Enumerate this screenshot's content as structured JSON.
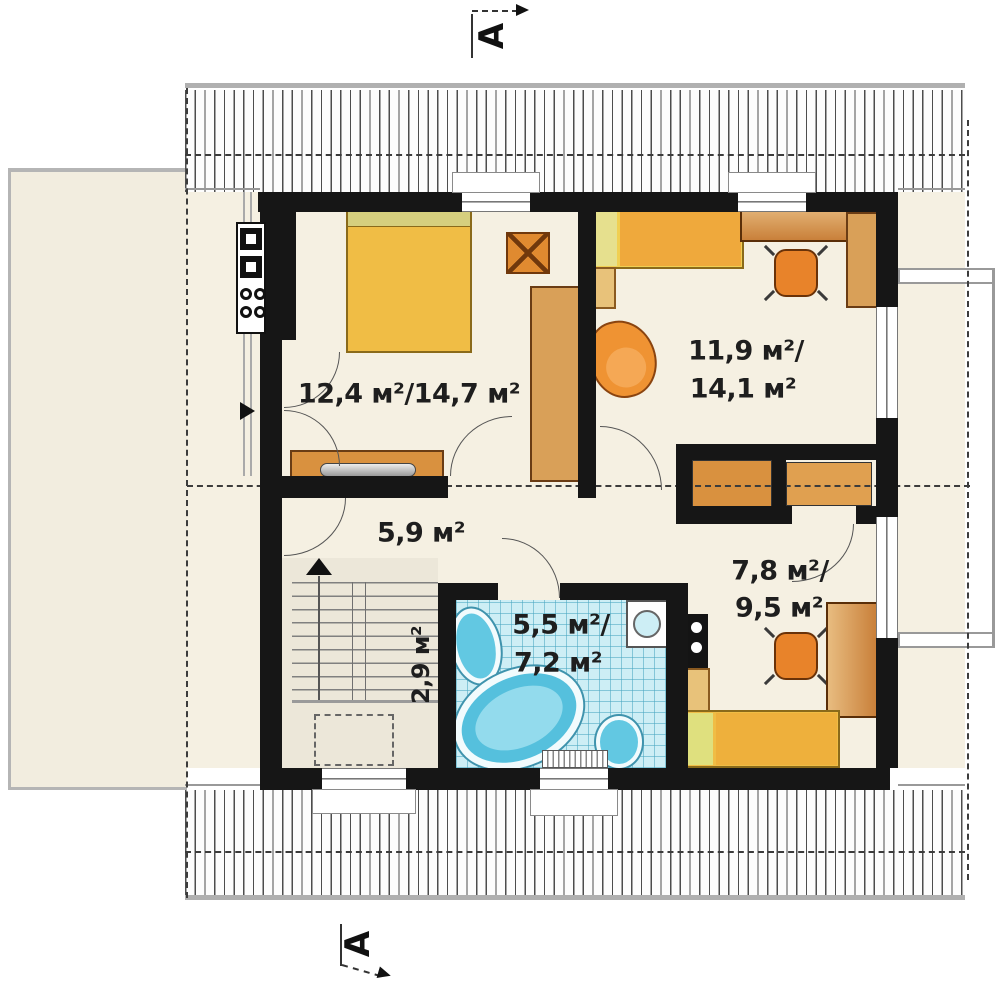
{
  "floorplan": {
    "section_marks": {
      "top": "A",
      "bottom": "A"
    },
    "rooms": {
      "bedroom": {
        "area": "12,4 м²/14,7 м²"
      },
      "room_top_right": {
        "area_line1": "11,9 м²/",
        "area_line2": "14,1 м²"
      },
      "hall": {
        "area": "5,9 м²"
      },
      "room_bottom_right": {
        "area_line1": "7,8 м²/",
        "area_line2": "9,5 м²"
      },
      "bathroom": {
        "area_line1": "5,5 м²/",
        "area_line2": "7,2 м²"
      },
      "staircase": {
        "area": "2,9 м²"
      }
    },
    "colors": {
      "wall": "#161616",
      "floor": "#f5f0e2",
      "bathroom_tile": "#cdeef5",
      "furniture_yellow": "#f0bd45",
      "furniture_wood": "#d9913f",
      "furniture_orange": "#e8832a",
      "fixture_blue": "#55c0dd"
    }
  }
}
